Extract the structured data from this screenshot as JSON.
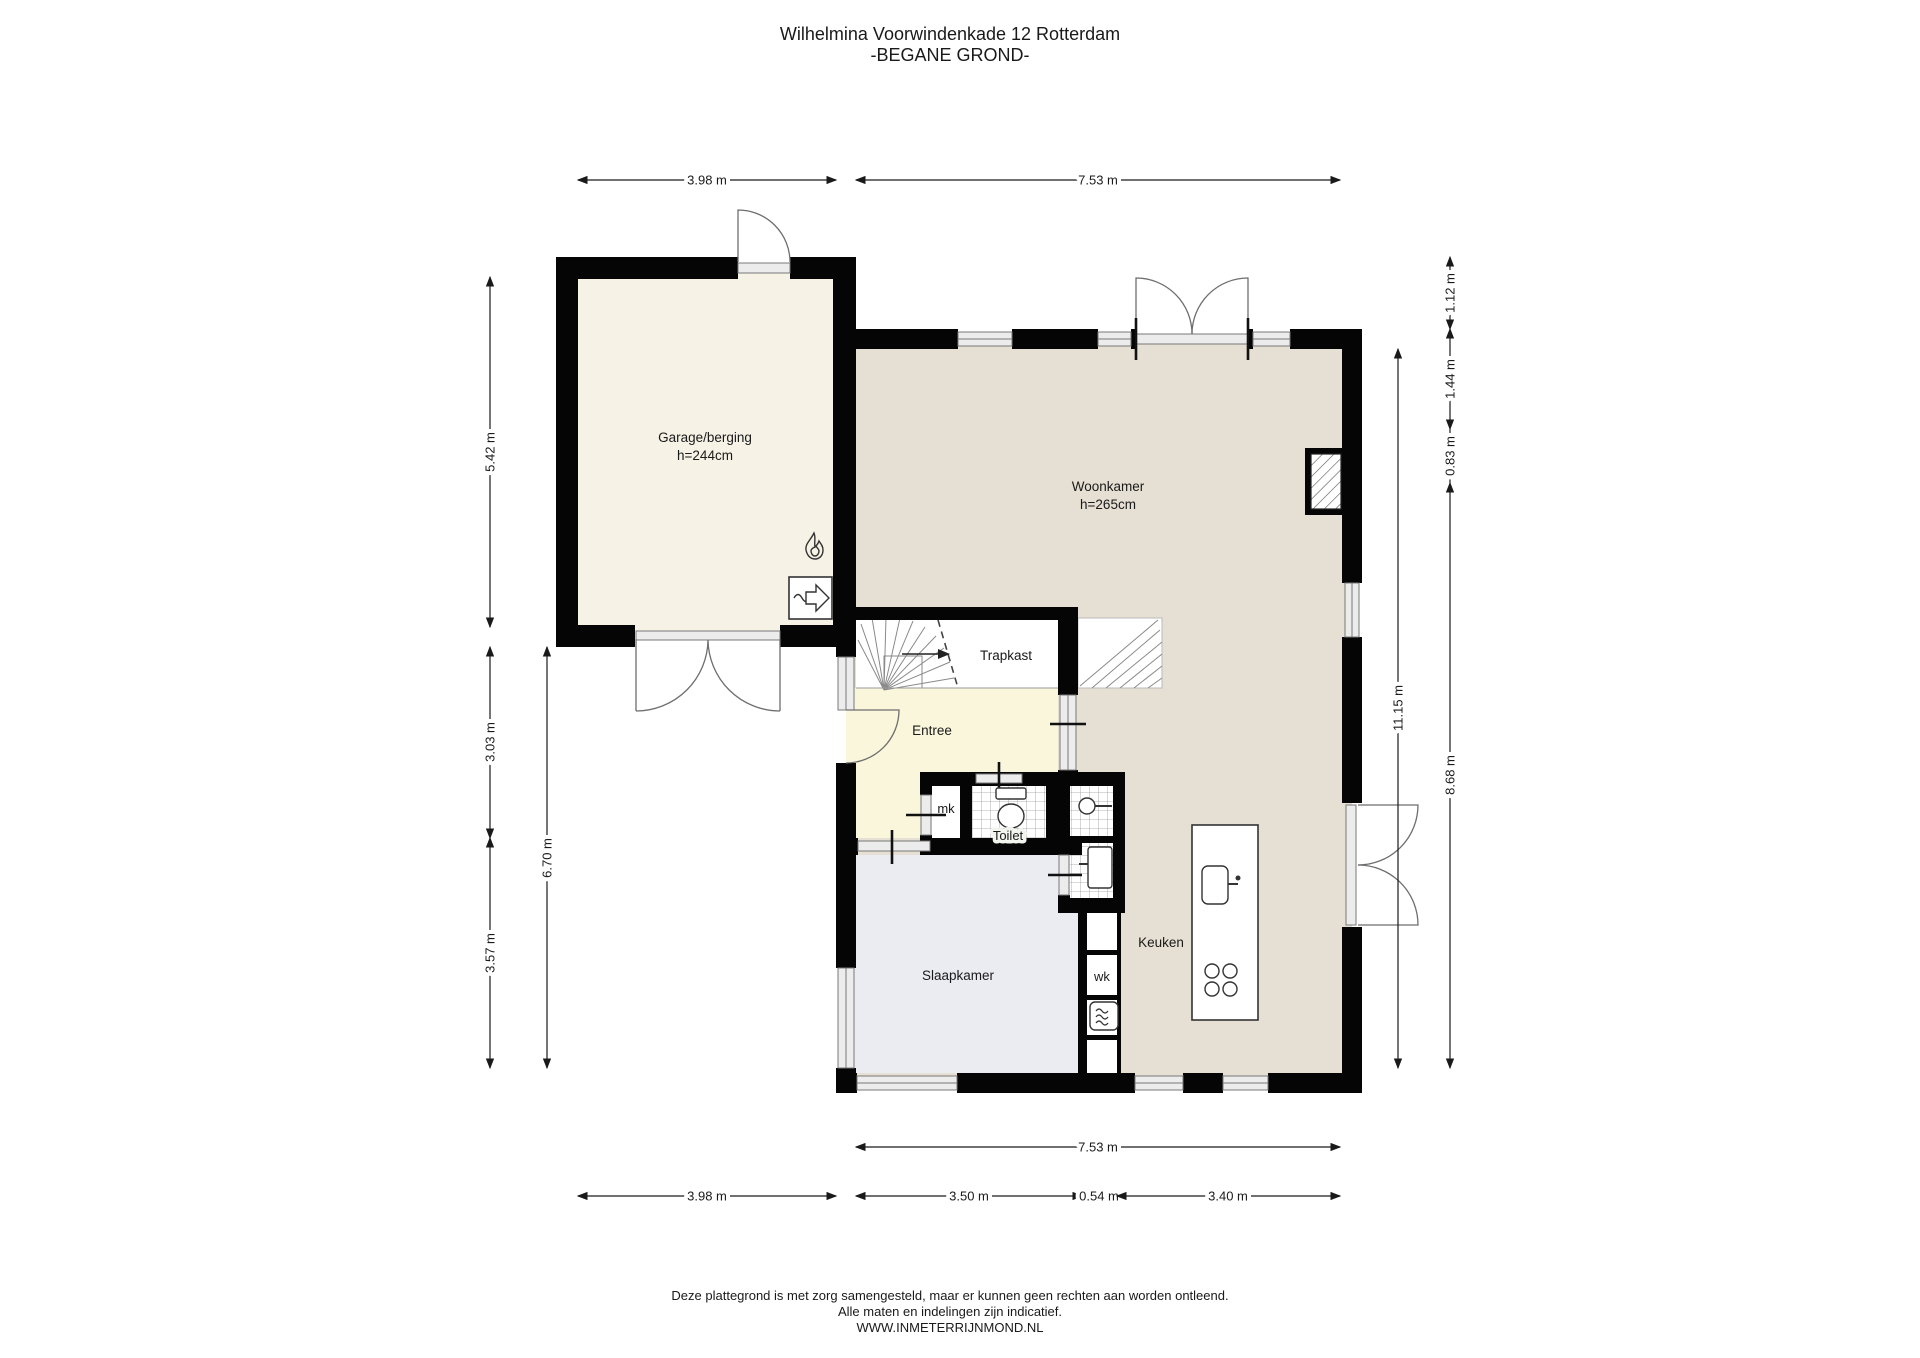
{
  "title": {
    "line1": "Wilhelmina Voorwindenkade 12 Rotterdam",
    "line2": "-BEGANE GROND-"
  },
  "rooms": {
    "garage": {
      "name": "Garage/berging",
      "height": "h=244cm"
    },
    "woonkamer": {
      "name": "Woonkamer",
      "height": "h=265cm"
    },
    "trapkast": {
      "name": "Trapkast"
    },
    "entree": {
      "name": "Entree"
    },
    "mk": {
      "name": "mk"
    },
    "toilet": {
      "name": "Toilet"
    },
    "slaapkamer": {
      "name": "Slaapkamer"
    },
    "wk": {
      "name": "wk"
    },
    "keuken": {
      "name": "Keuken"
    }
  },
  "dimensions": {
    "top": [
      "3.98 m",
      "7.53 m"
    ],
    "bottom_inner": "7.53 m",
    "bottom": [
      "3.98 m",
      "3.50 m",
      "0.54 m",
      "3.40 m"
    ],
    "left": [
      "5.42 m",
      "3.03 m",
      "3.57 m"
    ],
    "left_inner": "6.70 m",
    "right": [
      "1.12 m",
      "1.44 m",
      "0.83 m",
      "8.68 m"
    ],
    "right_inner": "11.15 m"
  },
  "footer": {
    "line1": "Deze plattegrond is met zorg samengesteld, maar er kunnen geen rechten aan worden ontleend.",
    "line2": "Alle maten en indelingen zijn indicatief.",
    "line3": "WWW.INMETERRIJNMOND.NL"
  },
  "icons": {
    "flame": "cv-boiler",
    "ventilation": "mechanical-ventilation-unit",
    "stair_direction": "up"
  },
  "colors": {
    "wall": "#050505",
    "garage_floor": "#f6f2e6",
    "living_floor": "#e6dfd3",
    "entree_floor": "#faf6dc",
    "bedroom_floor": "#ebebf2",
    "closet_floor": "#ffffff",
    "window": "#ececec"
  }
}
